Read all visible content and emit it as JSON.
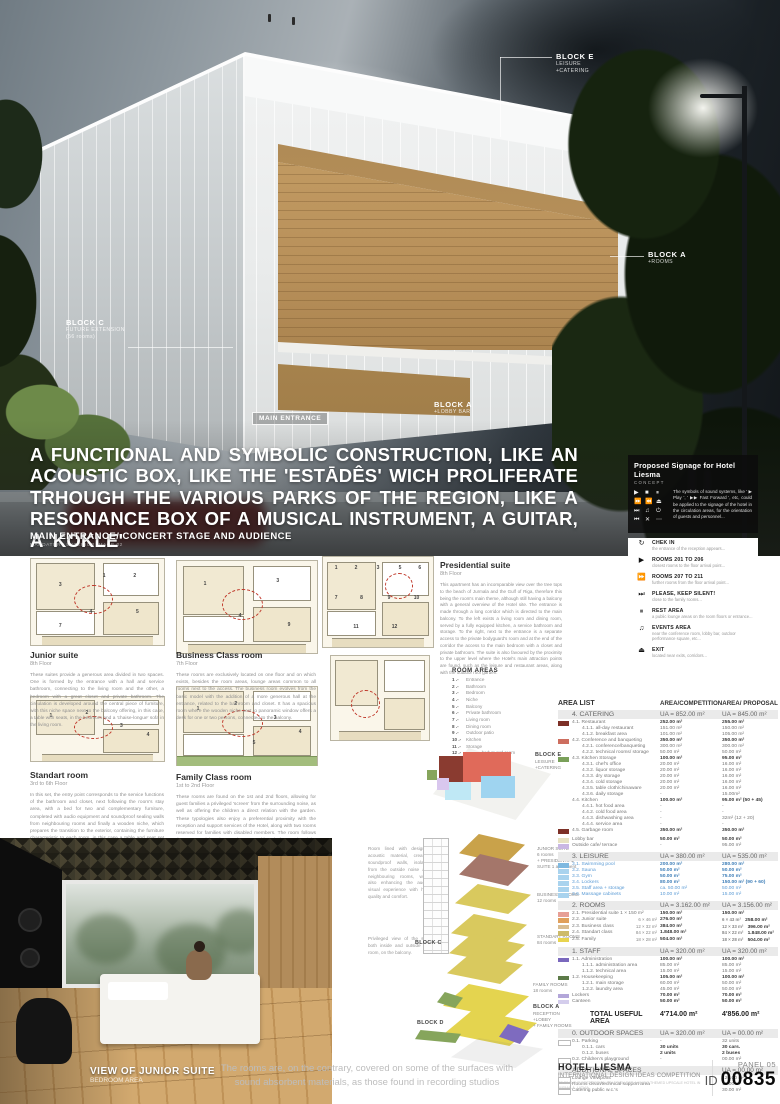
{
  "hero": {
    "headline": "A FUNCTIONAL AND SYMBOLIC CONSTRUCTION, LIKE AN ACOUSTIC BOX, LIKE THE 'ESTĀDÊS' WICH PROLIFERATE TRHOUGH THE VARIOUS PARKS OF THE REGION, LIKE A RESONANCE BOX OF A MUSICAL INSTRUMENT, A GUITAR, A 'KOKLE'",
    "caption": "MAIN ENTRANCE/ CONCERT STAGE AND AUDIENCE",
    "caption_sub": "MANDATORY EXTERIOR IMAGE 02",
    "labels": {
      "block_c": {
        "title": "BLOCK C",
        "line1": "FUTURE EXTENSION",
        "line2": "(56 rooms)"
      },
      "block_e": {
        "title": "BLOCK E",
        "line1": "LEISURE",
        "line2": "+CATERING"
      },
      "block_a_trees": {
        "title": "BLOCK A",
        "line1": "+ROOMS"
      },
      "main_entrance": "MAIN ENTRANCE",
      "block_a_lobby": {
        "title": "BLOCK A",
        "line1": "+LOBBY BAR"
      }
    }
  },
  "signage": {
    "title": "Proposed Signage for Hotel Liesma",
    "subtitle": "CONCEPT",
    "intro": "The symbols of sound systems, like ' ▶ Play ', ' ▶▶ Fast Forward ', etc, could be applied to the signage of the hotel in the circulation areas, for the orientation of guests and personnel...",
    "icon_grid": [
      "▶",
      "■",
      "⏸",
      "⏩",
      "⏪",
      "⏏",
      "⏭",
      "♫",
      "⏻",
      "⏮",
      "✕",
      "⋯"
    ],
    "items": [
      {
        "icon": "↻",
        "icon_name": "check-in-icon",
        "title": "CHEK IN",
        "desc": "the entrance of the reception appears..."
      },
      {
        "icon": "▶",
        "icon_name": "play-icon",
        "title": "ROOMS 201 TO 206",
        "desc": "closest rooms to the floor arrival point..."
      },
      {
        "icon": "⏩",
        "icon_name": "fast-forward-icon",
        "title": "ROOMS 207 TO 211",
        "desc": "further rooms from the floor arrival point..."
      },
      {
        "icon": "⏭",
        "icon_name": "skip-icon",
        "title": "PLEASE, KEEP SILENT!",
        "desc": "close to the family rooms..."
      },
      {
        "icon": "⏸",
        "icon_name": "pause-icon",
        "title": "REST AREA",
        "desc": "a public lounge areas on the room floors or entrance..."
      },
      {
        "icon": "♫",
        "icon_name": "music-note-icon",
        "title": "EVENTS AREA",
        "desc": "near the conference room, lobby bar, outdoor performance square, etc..."
      },
      {
        "icon": "⏏",
        "icon_name": "eject-icon",
        "title": "EXIT",
        "desc": "located near exits, corridors..."
      }
    ]
  },
  "plans": [
    {
      "title": "Junior suite",
      "floor": "8th Floor",
      "numbers": [
        "1",
        "2",
        "3",
        "4",
        "5",
        "7"
      ],
      "body": "These suites provide a generous area divided in two spaces. One is formed by the entrance with a hall and service bathroom, connecting to the living room and the other, a bedroom with a great closet and private bathroom. The circulation is developed around the central piece of furniture, with this niche space next to the balcony offering, in this case, a table with seats, in the bedroom and a 'chaise-longue' sofa in the living room."
    },
    {
      "title": "Business Class room",
      "floor": "7th Floor",
      "numbers": [
        "1",
        "3",
        "4",
        "9"
      ],
      "body": "These rooms are exclusively located on one floor and on which exists, besides the room areas, lounge areas common to all rooms next to the access. The business room evolves from the basic model with the addition of a more generous hall at the entrance, related to the bathroom and closet. It has a spacious room where the wooden niche next to panoramic window offers a desk for one or two persons, connected to the balcony."
    },
    {
      "title": "Standart room",
      "floor": "3rd to 6th Floor",
      "numbers": [
        "1",
        "2",
        "3",
        "4"
      ],
      "body": "In this set, the entry point corresponds to the service functions of the bathroom and closet, next following the room's stay area, with a bed for two and complementary furniture, completed with audio equipment and soundproof sealing walls from neighbouring rooms and finally a wooden niche, which prepares the transition to the exterior, containing the furniture characteristic to each room, in this case a table and seat set for breakfast with a panoramic view and access to the balcony."
    },
    {
      "title": "Family Class room",
      "floor": "1st to 2nd Floor",
      "numbers": [
        "1",
        "2",
        "3",
        "4",
        "5"
      ],
      "body": "These rooms are found on the 1st and 2nd floors, allowing for guest families a privileged 'screen' from the surrounding noise, as well as offering the children a direct relation with the garden. These typologies also enjoy a preferential proximity with the reception and support services of the Hotel, along with two rooms reserved for families with disabled members. The room follows the same model as the standart room, although the wooden niche offers a variant of the table and seat sets with a cradle or single bed."
    },
    {
      "title": "Presidential suite",
      "floor": "8th Floor",
      "numbers": [
        "1",
        "2",
        "3",
        "5",
        "6",
        "7",
        "8",
        "9",
        "10",
        "11",
        "12"
      ],
      "body": "This apartment has an incomparable view over the tree tops to the beach of Jurmala and the Gulf of Riga, therefore this being the room's main theme, although still having a balcony with a general overview of the Hotel site. The entrance is made through a long corridor which is directed to the main balcony. To the left exists a living room and dining room, served by a fully equipped kitchen, a service bathroom and storage. To the right, next to the entrance is a separate access to the private bodyguard's room and at the end of the corridor the access to the main bedroom with a closet and private bathroom. The suite is also favoured by the proximity to the upper level where the Hotel's main attraction points are found, such as the leisure and restaurant areas, along with the outdoor roof garden."
    }
  ],
  "room_areas": {
    "title": "ROOM AREAS",
    "items": [
      "Entrance",
      "Bathroom",
      "Bedroom",
      "Niche",
      "Balcony",
      "Private bathroom",
      "Living room",
      "Dining room",
      "Outdoor patio",
      "Kitchen",
      "Storage",
      "Private bodyguard room"
    ]
  },
  "interior": {
    "caption": "VIEW OF JUNIOR SUITE",
    "caption_sub": "BEDROOM AREA",
    "note1": "Room lined with designed acoustic material, creating soundproof walls, isolated from the outside noise and neighbouring rooms, while also enhancing the audio-visual experience with high quality and comfort.",
    "note2": "Privileged view of the sea, both inside and outside the room, on the balcony.",
    "bottom_text": "The rooms are, on the contrary, covered on some of the surfaces with\nsound absorbent materials, as those found in recording studios"
  },
  "axon": {
    "labels": [
      {
        "title": "BLOCK E",
        "lines": [
          "LEISURE",
          "+CATERING"
        ]
      },
      {
        "title": "",
        "lines": [
          "JUNIOR SUITE",
          "6 rooms",
          "+ PRESIDENTIAL",
          "SUITE 1 apartment"
        ]
      },
      {
        "title": "",
        "lines": [
          "BUSINESS ROOMS",
          "12 rooms"
        ]
      },
      {
        "title": "",
        "lines": [
          "STANDART ROOMS",
          "84 rooms"
        ]
      },
      {
        "title": "",
        "lines": [
          "FAMILY ROOMS",
          "18 rooms"
        ]
      },
      {
        "title": "BLOCK A",
        "lines": [
          "RECEPTION",
          "+LOBBY",
          "+ FAMILY ROOMS"
        ]
      },
      {
        "title": "BLOCK C",
        "lines": []
      },
      {
        "title": "BLOCK D",
        "lines": []
      }
    ]
  },
  "table": {
    "headers": [
      "AREA LIST",
      "AREA/COMPETITION",
      "AREA/ PROPOSAL"
    ],
    "sections": [
      {
        "name": "4. CATERING",
        "comp": "UA = 852.00 m²",
        "prop": "UA = 845.00 m²",
        "tone": "default",
        "rows": [
          {
            "swatch": "#7d3027",
            "indent": 0,
            "label": "4.1. Restaurant",
            "comp": "252.00 m²",
            "prop": "255.00 m²",
            "bold": true
          },
          {
            "indent": 1,
            "label": "4.1.1. all-day restaurant",
            "comp": "151.00 m²",
            "prop": "150.00 m²"
          },
          {
            "indent": 1,
            "label": "4.1.2. breakfast area",
            "comp": "101.00 m²",
            "prop": "105.00 m²"
          },
          {
            "swatch": "#cd6e5f",
            "indent": 0,
            "label": "4.2. Conference and banqueting",
            "comp": "350.00 m²",
            "prop": "350.00 m²",
            "bold": true
          },
          {
            "indent": 1,
            "label": "4.2.1. conference/banqueting",
            "comp": "300.00 m²",
            "prop": "300.00 m²"
          },
          {
            "indent": 1,
            "label": "4.2.2. technical rooms/ storage",
            "comp": "50.00 m²",
            "prop": "50.00 m²"
          },
          {
            "swatch": "#7aa05a",
            "indent": 0,
            "label": "4.3. Kitchen Storage",
            "comp": "100.00 m²",
            "prop": "95.00 m²",
            "bold": true
          },
          {
            "indent": 1,
            "label": "4.3.1. chef's office",
            "comp": "20.00 m²",
            "prop": "16.00 m²"
          },
          {
            "indent": 1,
            "label": "4.3.2. liquor storage",
            "comp": "20.00 m²",
            "prop": "16.00 m²"
          },
          {
            "indent": 1,
            "label": "4.3.3. dry storage",
            "comp": "20.00 m²",
            "prop": "16.00 m²"
          },
          {
            "indent": 1,
            "label": "4.3.4. cold storage",
            "comp": "20.00 m²",
            "prop": "16.00 m²"
          },
          {
            "indent": 1,
            "label": "4.3.5. table cloth/chinaware",
            "comp": "20.00 m²",
            "prop": "16.00 m²"
          },
          {
            "indent": 1,
            "label": "4.3.6. daily storage",
            "comp": "-",
            "prop": "15.00m²"
          },
          {
            "indent": 0,
            "label": "4.4. Kitchen",
            "comp": "100.00 m²",
            "prop": "95.00 m² (50 + 45)",
            "bold": true
          },
          {
            "indent": 1,
            "label": "4.4.1. hot food area",
            "comp": "-",
            "prop": "-"
          },
          {
            "indent": 1,
            "label": "4.4.2. cold food area",
            "comp": "-",
            "prop": "-"
          },
          {
            "indent": 1,
            "label": "4.4.3. dishwashing area",
            "comp": "-",
            "prop": "32m² (12 + 20)"
          },
          {
            "indent": 1,
            "label": "4.4.4. service area",
            "comp": "-",
            "prop": "-"
          },
          {
            "swatch": "#7d3027",
            "indent": 0,
            "label": "4.5. Garbage room",
            "comp": "350.00 m²",
            "prop": "350.00 m²",
            "bold": true
          },
          {
            "swatch": "#e7e2c3",
            "indent": 0,
            "label": "Lobby bar",
            "comp": "50.00 m²",
            "prop": "50.00 m²",
            "bold": true,
            "gap": true
          },
          {
            "swatch": "#c9b7e3",
            "indent": 0,
            "label": "Outside cafe/ terrace",
            "comp": "-",
            "prop": "95.00 m²"
          }
        ]
      },
      {
        "name": "3. LEISURE",
        "comp": "UA = 380.00 m²",
        "prop": "UA = 535.00 m²",
        "tone": "blue",
        "rows": [
          {
            "swatch": "#7fb9e0",
            "indent": 0,
            "label": "3.1. Swimming pool",
            "comp": "200.00 m²",
            "prop": "280.00 m²",
            "bold": true
          },
          {
            "swatch": "#a9d3ee",
            "indent": 0,
            "label": "3.2. Sauna",
            "comp": "50.00 m²",
            "prop": "50.00 m²",
            "bold": true
          },
          {
            "swatch": "#a9d3ee",
            "indent": 0,
            "label": "3.3. Gym",
            "comp": "50.00 m²",
            "prop": "75.00 m²",
            "bold": true
          },
          {
            "swatch": "#a9d3ee",
            "indent": 0,
            "label": "3.4. Lockers",
            "comp": "80.00 m²",
            "prop": "150.00 m² (90 + 60)",
            "bold": true
          },
          {
            "swatch": "#a9d3ee",
            "indent": 0,
            "label": "3.5. Staff area + storage",
            "comp": "ca. 50.00 m²",
            "prop": "50.00 m²"
          },
          {
            "swatch": "#a9d3ee",
            "indent": 0,
            "label": "3.6. Massage cabinets",
            "comp": "10.00 m²",
            "prop": "15.00 m²"
          }
        ]
      },
      {
        "name": "2. ROOMS",
        "comp": "UA = 3.162.00 m²",
        "prop": "UA = 3.156.00 m²",
        "tone": "default",
        "rows": [
          {
            "swatch": "#e79f96",
            "indent": 0,
            "label": "2.1. Presidential suite 1 × 150 m²",
            "comp": "150.00 m²",
            "prop": "150.00 m²",
            "bold": true
          },
          {
            "swatch": "#e0a05c",
            "indent": 0,
            "label": "2.2. Junior suite",
            "comp_note": "6 × 46 m²",
            "comp": "276.00 m²",
            "prop_note": "6 × 43 m²",
            "prop": "258.00 m²",
            "bold": true
          },
          {
            "swatch": "#d9bd92",
            "indent": 0,
            "label": "2.3. Business class",
            "comp_note": "12 × 32 m²",
            "comp": "384.00 m²",
            "prop_note": "12 × 33 m²",
            "prop": "396.00 m²",
            "bold": true
          },
          {
            "swatch": "#cdbb6a",
            "indent": 0,
            "label": "2.4. Standart class",
            "comp_note": "84 × 22 m²",
            "comp": "1.848.00 m²",
            "prop_note": "84 × 22 m²",
            "prop": "1.848.00 m²",
            "bold": true
          },
          {
            "swatch": "#e8d44f",
            "indent": 0,
            "label": "2.5. Family",
            "comp_note": "18 × 28 m²",
            "comp": "504.00 m²",
            "prop_note": "18 × 28 m²",
            "prop": "504.00 m²",
            "bold": true
          }
        ]
      },
      {
        "name": "1. STAFF",
        "comp": "UA = 320.00 m²",
        "prop": "UA = 320.00 m²",
        "tone": "default",
        "rows": [
          {
            "swatch": "#7a68bd",
            "indent": 0,
            "label": "1.1. Administration",
            "comp": "100.00 m²",
            "prop": "100.00 m²",
            "bold": true
          },
          {
            "indent": 1,
            "label": "1.1.1. administration area",
            "comp": "85.00 m²",
            "prop": "85.00 m²"
          },
          {
            "indent": 1,
            "label": "1.1.2. technical area",
            "comp": "15.00 m²",
            "prop": "15.00 m²"
          },
          {
            "swatch": "#5c7a48",
            "indent": 0,
            "label": "1.2. Housekeeping",
            "comp": "105.00 m²",
            "prop": "100.00 m²",
            "bold": true
          },
          {
            "indent": 1,
            "label": "1.2.1. main storage",
            "comp": "60.00 m²",
            "prop": "50.00 m²"
          },
          {
            "indent": 1,
            "label": "1.2.2. laundry area",
            "comp": "45.00 m²",
            "prop": "50.00 m²"
          },
          {
            "swatch": "#b3a6d9",
            "indent": 0,
            "label": "Lockers",
            "comp": "70.00 m²",
            "prop": "70.00 m²",
            "bold": true
          },
          {
            "swatch": "#d4cdec",
            "indent": 0,
            "label": "Canteen",
            "comp": "50.00 m²",
            "prop": "50.00 m²",
            "bold": true
          }
        ]
      },
      {
        "type": "total",
        "label": "TOTAL USEFUL AREA",
        "comp": "4'714.00 m²",
        "prop": "4'856.00 m²"
      },
      {
        "name": "0. OUTDOOR SPACES",
        "comp": "UA = 320.00 m²",
        "prop": "UA = 00.00 m²",
        "tone": "default",
        "rows": [
          {
            "swatch": "outline",
            "indent": 0,
            "label": "0.1. Parking",
            "comp": "-",
            "prop": "32 units"
          },
          {
            "indent": 1,
            "label": "0.1.1. cars",
            "comp": "30 units",
            "prop": "30 cars.",
            "bold": true
          },
          {
            "indent": 1,
            "label": "0.1.2. buses",
            "comp": "2 units",
            "prop": "2  buses",
            "bold": true
          },
          {
            "swatch": "outline",
            "indent": 0,
            "label": "0.2. Children's playground",
            "comp": "-",
            "prop": "00.00 m²"
          }
        ]
      },
      {
        "name": "ADDITIONAL SPACES",
        "comp": "",
        "prop": "UA = 00.00 m²",
        "tone": "default",
        "rows": [
          {
            "swatch": "outline",
            "indent": 0,
            "label": "Lounge Viewpoint",
            "comp": "",
            "prop": "120.00 m²"
          },
          {
            "swatch": "outline",
            "indent": 0,
            "label": "Rooms clean/technical support area",
            "comp": "",
            "prop": "18.00 m²"
          },
          {
            "swatch": "outline",
            "indent": 0,
            "label": "Catering public w.c.'s",
            "comp": "",
            "prop": "30.00 m²"
          }
        ]
      }
    ]
  },
  "footer": {
    "brand": "HOTEL LIESMA",
    "competition": "INTERNATIONAL DESIGN IDEAS COMPETITION",
    "tagline": "TO FIND THE BEST DESIGN SOLUTION FOR A MUSIC THEMED UPSCALE HOTEL IN JURMALA, LATVIA",
    "panel_no": "PANEL 05",
    "id_prefix": "ID",
    "id_number": "00835"
  }
}
